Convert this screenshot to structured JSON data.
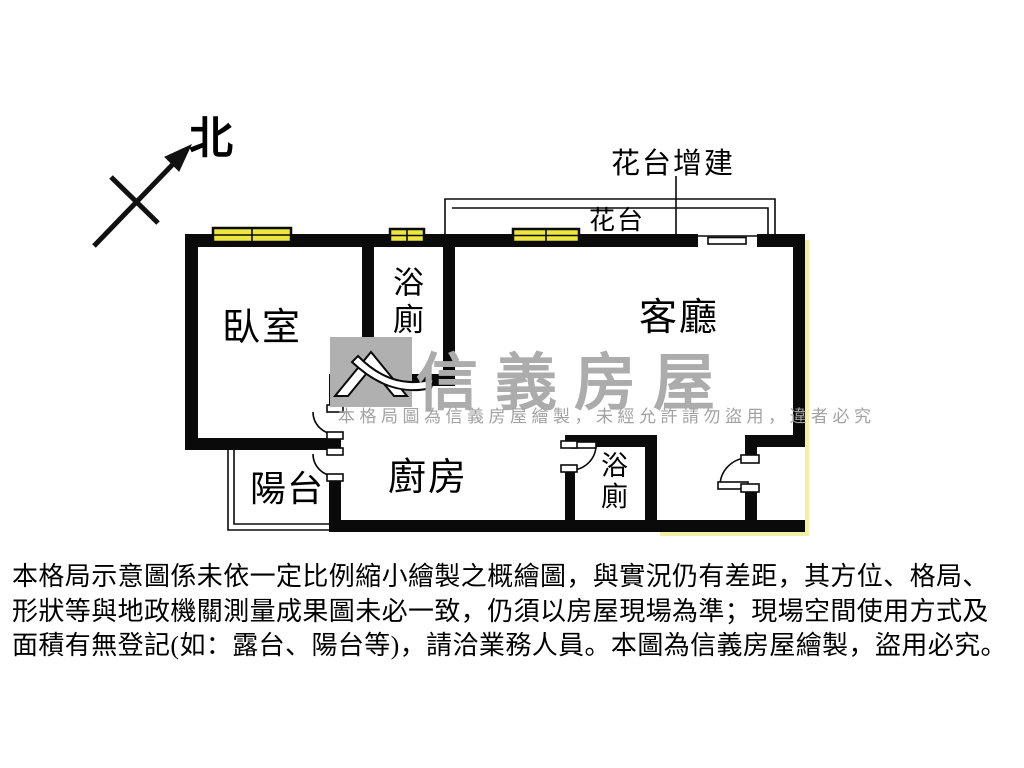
{
  "compass": {
    "north_label": "北"
  },
  "annotations": {
    "flower_addition_title": "花台增建",
    "flower_ledge_label": "花台"
  },
  "rooms": {
    "bedroom": "臥室",
    "bathroom1": "浴廁",
    "living_room": "客廳",
    "balcony": "陽台",
    "kitchen": "廚房",
    "bathroom2": "浴廁"
  },
  "watermark": {
    "brand": "信義房屋",
    "notice": "本格局圖為信義房屋繪製，未經允許請勿盜用，違者必究"
  },
  "disclaimer": {
    "line1": "本格局示意圖係未依一定比例縮小繪製之概繪圖，與實況仍有差距，其方位、格局、",
    "line2": "形狀等與地政機關測量成果圖未必一致，仍須以房屋現場為準；現場空間使用方式及",
    "line3": "面積有無登記(如：露台、陽台等)，請洽業務人員。本圖為信義房屋繪製，盜用必究。"
  },
  "colors": {
    "wall_black": "#0a0a0a",
    "window_yellow": "#ece63e",
    "watermark_gray": "#acacac",
    "shadow_yellow": "#f3efa3"
  }
}
